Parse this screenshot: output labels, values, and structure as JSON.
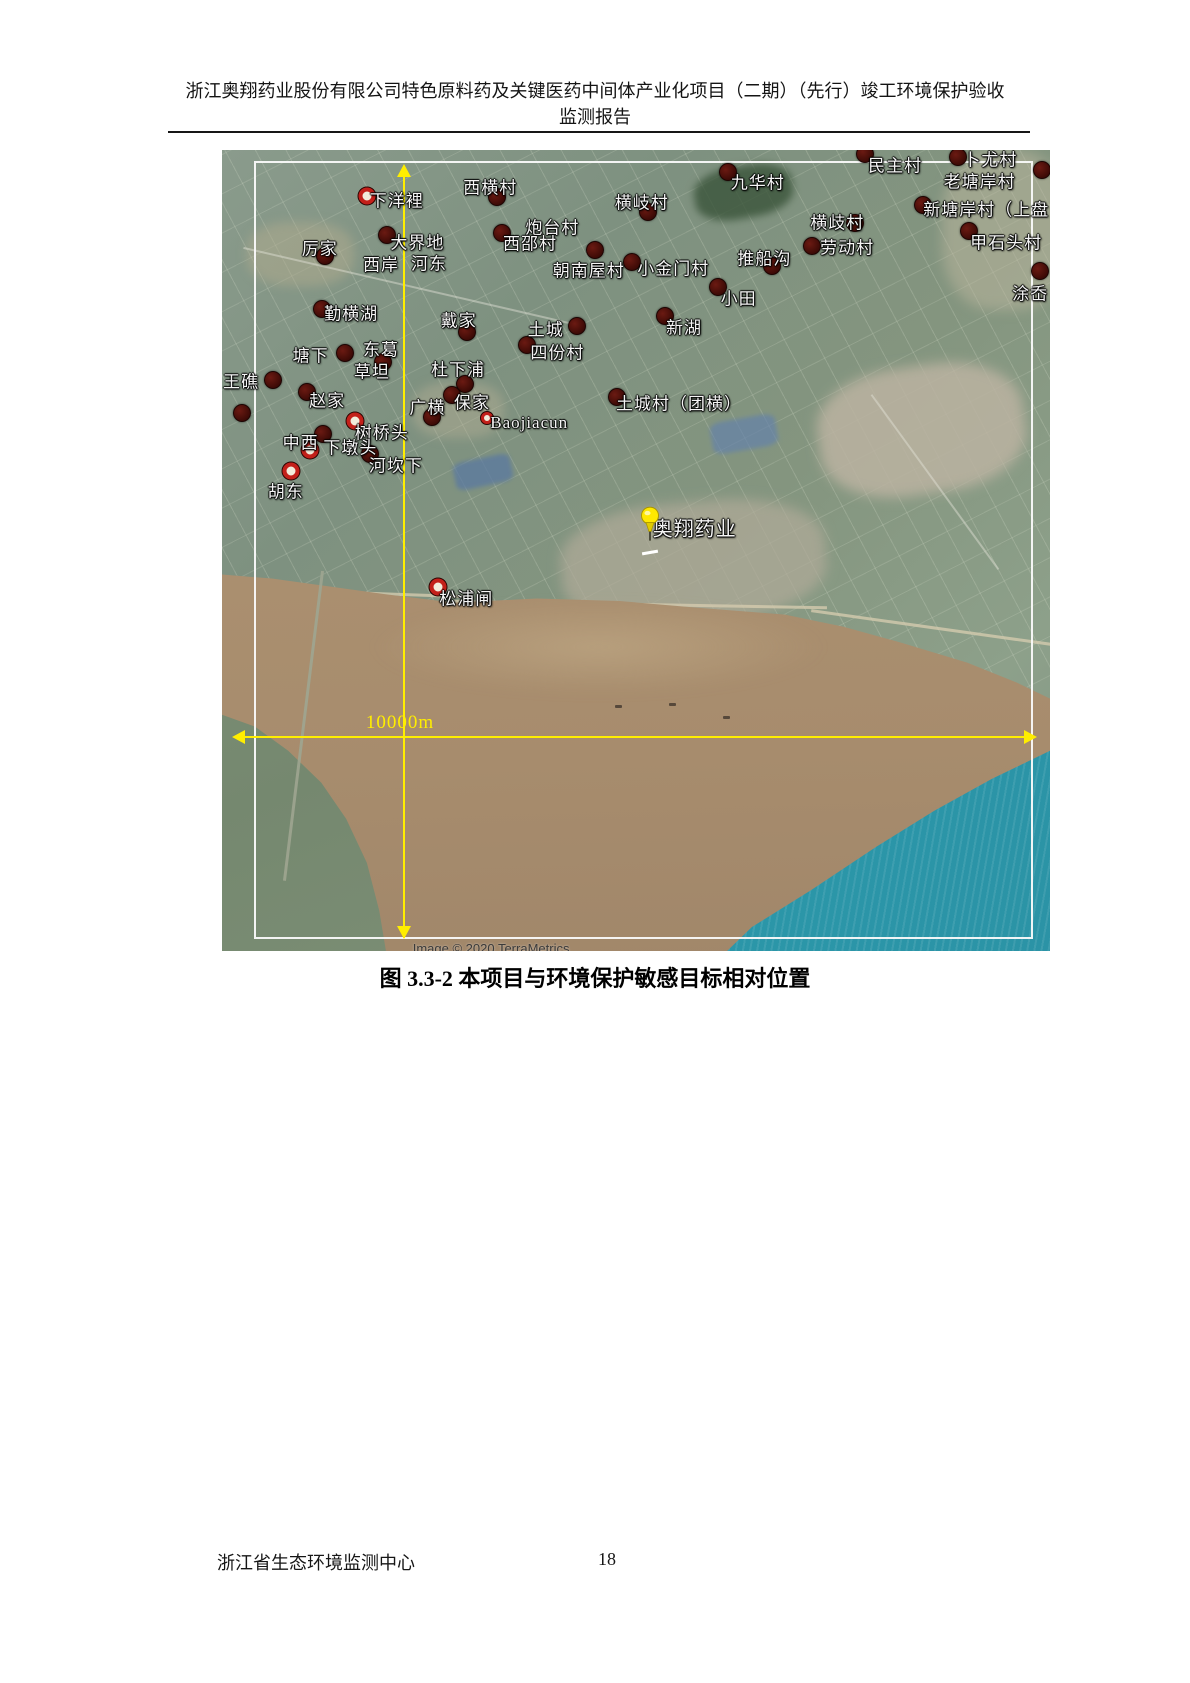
{
  "header": {
    "line1": "浙江奥翔药业股份有限公司特色原料药及关键医药中间体产业化项目（二期）（先行）竣工环境保护验收",
    "line2": "监测报告"
  },
  "caption": "图 3.3-2  本项目与环境保护敏感目标相对位置",
  "footer": {
    "organization": "浙江省生态环境监测中心",
    "page_number": "18"
  },
  "map": {
    "scale_label": "10000m",
    "attribution": "Image © 2020 TerraMetrics",
    "site_label": "奥翔药业",
    "colors": {
      "accent_yellow": "#ffee00",
      "frame_white": "#f8f8f8",
      "marker_dark": "#4a0d08",
      "marker_ring_red": "#c3201a",
      "land_green": "#84957f",
      "water_brown": "#ab9070",
      "ocean_teal": "#2f9fae"
    },
    "labels": [
      {
        "text": "下洋裡",
        "x": 21.1,
        "y": 6.1
      },
      {
        "text": "西横村",
        "x": 32.4,
        "y": 4.5
      },
      {
        "text": "横岐村",
        "x": 50.7,
        "y": 6.4
      },
      {
        "text": "九华村",
        "x": 64.7,
        "y": 3.9
      },
      {
        "text": "民主村",
        "x": 81.3,
        "y": 1.7
      },
      {
        "text": "卜尤村",
        "x": 92.8,
        "y": 1.0
      },
      {
        "text": "老塘岸村",
        "x": 91.5,
        "y": 3.7
      },
      {
        "text": "新塘岸村（上盘",
        "x": 92.3,
        "y": 7.2
      },
      {
        "text": "甲石头村",
        "x": 94.7,
        "y": 11.4
      },
      {
        "text": "涂岙",
        "x": 97.6,
        "y": 17.7
      },
      {
        "text": "横歧村",
        "x": 74.3,
        "y": 8.9
      },
      {
        "text": "劳动村",
        "x": 75.5,
        "y": 12.0
      },
      {
        "text": "推船沟",
        "x": 65.5,
        "y": 13.4
      },
      {
        "text": "厉家",
        "x": 11.8,
        "y": 12.1
      },
      {
        "text": "大界地",
        "x": 23.6,
        "y": 11.4
      },
      {
        "text": "西岸",
        "x": 19.2,
        "y": 14.1
      },
      {
        "text": "河东",
        "x": 25.0,
        "y": 14.0
      },
      {
        "text": "炮台村",
        "x": 39.9,
        "y": 9.5
      },
      {
        "text": "西邵村",
        "x": 37.2,
        "y": 11.5
      },
      {
        "text": "朝南屋村",
        "x": 44.3,
        "y": 14.9
      },
      {
        "text": "小金门村",
        "x": 54.5,
        "y": 14.6
      },
      {
        "text": "小田",
        "x": 62.4,
        "y": 18.3
      },
      {
        "text": "新湖",
        "x": 55.8,
        "y": 22.0
      },
      {
        "text": "勤横湖",
        "x": 15.6,
        "y": 20.2
      },
      {
        "text": "戴家",
        "x": 28.6,
        "y": 21.1
      },
      {
        "text": "土城",
        "x": 39.1,
        "y": 22.2
      },
      {
        "text": "四份村",
        "x": 40.5,
        "y": 25.1
      },
      {
        "text": "塘下",
        "x": 10.7,
        "y": 25.5
      },
      {
        "text": "东葛",
        "x": 19.2,
        "y": 24.7
      },
      {
        "text": "草坦",
        "x": 18.1,
        "y": 27.5
      },
      {
        "text": "王礁",
        "x": 2.3,
        "y": 28.7
      },
      {
        "text": "赵家",
        "x": 12.7,
        "y": 31.1
      },
      {
        "text": "杜下浦",
        "x": 28.5,
        "y": 27.2
      },
      {
        "text": "广横",
        "x": 24.8,
        "y": 32.0
      },
      {
        "text": "保家",
        "x": 30.2,
        "y": 31.3
      },
      {
        "text": "Baojiacun",
        "x": 37.1,
        "y": 34.1,
        "latin": true
      },
      {
        "text": "树桥头",
        "x": 19.3,
        "y": 35.1
      },
      {
        "text": "中西",
        "x": 9.5,
        "y": 36.3
      },
      {
        "text": "下墩头",
        "x": 15.5,
        "y": 37.0
      },
      {
        "text": "河坎下",
        "x": 21.0,
        "y": 39.2
      },
      {
        "text": "胡东",
        "x": 7.7,
        "y": 42.4
      },
      {
        "text": "土城村（团横）",
        "x": 55.2,
        "y": 31.5
      },
      {
        "text": "奥翔药业",
        "x": 57.1,
        "y": 47.1,
        "size": 20
      },
      {
        "text": "松浦闸",
        "x": 29.5,
        "y": 55.8
      }
    ],
    "markers": [
      {
        "x": 17.5,
        "y": 5.7,
        "style": "ring"
      },
      {
        "x": 33.2,
        "y": 5.9,
        "style": "dark"
      },
      {
        "x": 51.4,
        "y": 7.7,
        "style": "dark"
      },
      {
        "x": 61.1,
        "y": 2.7,
        "style": "dark"
      },
      {
        "x": 77.7,
        "y": 0.5,
        "style": "dark"
      },
      {
        "x": 88.9,
        "y": 0.9,
        "style": "dark"
      },
      {
        "x": 99.0,
        "y": 2.5,
        "style": "dark"
      },
      {
        "x": 84.7,
        "y": 6.9,
        "style": "dark"
      },
      {
        "x": 90.2,
        "y": 10.1,
        "style": "dark"
      },
      {
        "x": 98.8,
        "y": 15.1,
        "style": "dark"
      },
      {
        "x": 76.4,
        "y": 9.1,
        "style": "dark"
      },
      {
        "x": 71.3,
        "y": 12.0,
        "style": "dark"
      },
      {
        "x": 66.4,
        "y": 14.5,
        "style": "dark"
      },
      {
        "x": 19.9,
        "y": 10.6,
        "style": "dark"
      },
      {
        "x": 12.4,
        "y": 13.2,
        "style": "dark"
      },
      {
        "x": 33.8,
        "y": 10.4,
        "style": "dark"
      },
      {
        "x": 45.0,
        "y": 12.5,
        "style": "dark"
      },
      {
        "x": 49.5,
        "y": 14.0,
        "style": "dark"
      },
      {
        "x": 12.1,
        "y": 19.8,
        "style": "dark"
      },
      {
        "x": 29.6,
        "y": 22.7,
        "style": "dark"
      },
      {
        "x": 42.9,
        "y": 22.0,
        "style": "dark"
      },
      {
        "x": 36.8,
        "y": 24.3,
        "style": "dark"
      },
      {
        "x": 53.5,
        "y": 20.7,
        "style": "dark"
      },
      {
        "x": 59.9,
        "y": 17.1,
        "style": "dark"
      },
      {
        "x": 14.9,
        "y": 25.3,
        "style": "dark"
      },
      {
        "x": 19.4,
        "y": 26.5,
        "style": "dark"
      },
      {
        "x": 6.2,
        "y": 28.7,
        "style": "dark"
      },
      {
        "x": 10.3,
        "y": 30.2,
        "style": "dark"
      },
      {
        "x": 2.4,
        "y": 32.8,
        "style": "dark"
      },
      {
        "x": 29.3,
        "y": 29.2,
        "style": "dark"
      },
      {
        "x": 25.4,
        "y": 33.3,
        "style": "dark"
      },
      {
        "x": 27.8,
        "y": 30.6,
        "style": "dark"
      },
      {
        "x": 32.0,
        "y": 33.5,
        "style": "ring-small"
      },
      {
        "x": 16.1,
        "y": 33.8,
        "style": "ring"
      },
      {
        "x": 10.6,
        "y": 37.5,
        "style": "ring"
      },
      {
        "x": 12.2,
        "y": 35.5,
        "style": "dark"
      },
      {
        "x": 17.9,
        "y": 38.0,
        "style": "dark"
      },
      {
        "x": 8.3,
        "y": 40.1,
        "style": "ring"
      },
      {
        "x": 47.7,
        "y": 30.8,
        "style": "dark"
      },
      {
        "x": 26.1,
        "y": 54.6,
        "style": "ring"
      }
    ]
  }
}
